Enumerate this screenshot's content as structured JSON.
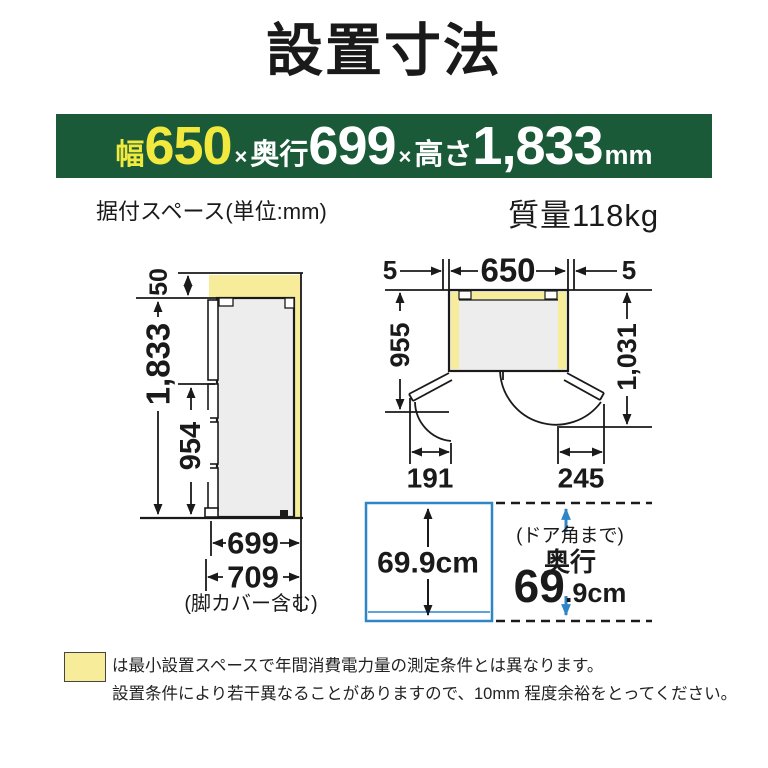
{
  "title": "設置寸法",
  "banner": {
    "width_label": "幅",
    "width_value": "650",
    "times1": "×",
    "depth_label": "奥行",
    "depth_value": "699",
    "times2": "×",
    "height_label": "高さ",
    "height_value": "1,833",
    "unit": "mm",
    "bg_color": "#1a5a38",
    "highlight_color": "#f2e93e"
  },
  "subheader": {
    "space_note": "据付スペース(単位:mm)",
    "weight": "質量118kg"
  },
  "side_view": {
    "clearance_top": "50",
    "height_total": "1,833",
    "height_door": "954",
    "depth_body": "699",
    "depth_with_cover": "709",
    "cover_note": "(脚カバー含む)"
  },
  "top_view": {
    "clearance_left": "5",
    "width": "650",
    "clearance_right": "5",
    "depth_open": "955",
    "depth_corner": "1,031",
    "door_left_swing": "191",
    "door_right_swing": "245"
  },
  "depth_section": {
    "box_value": "69.9cm",
    "corner_note": "(ドア角まで)",
    "depth_label": "奥行",
    "depth_big": "69",
    "depth_small": ".9cm",
    "accent_color": "#2f86c7"
  },
  "footer": {
    "line1": "は最小設置スペースで年間消費電力量の測定条件とは異なります。",
    "line2": "設置条件により若干異なることがありますので、10mm 程度余裕をとってください。"
  },
  "colors": {
    "clearance_yellow": "#f7ec99",
    "body_gray": "#ededed",
    "line_black": "#1a1a1a",
    "accent_blue": "#2f86c7",
    "banner_green": "#1a5a38"
  }
}
